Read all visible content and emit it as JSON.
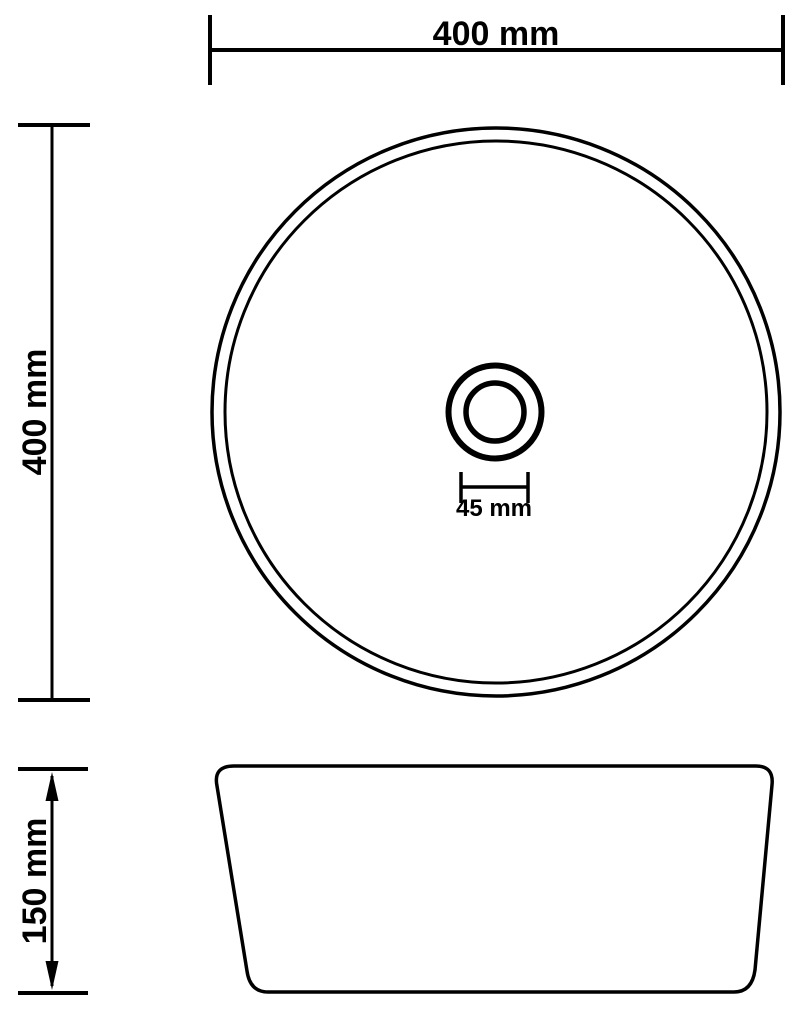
{
  "colors": {
    "line": "#000000",
    "background": "#ffffff"
  },
  "dimensions": {
    "top_width": {
      "label": "400 mm"
    },
    "left_height": {
      "label": "400 mm"
    },
    "drain_width": {
      "label": "45 mm"
    },
    "side_height": {
      "label": "150 mm"
    }
  }
}
